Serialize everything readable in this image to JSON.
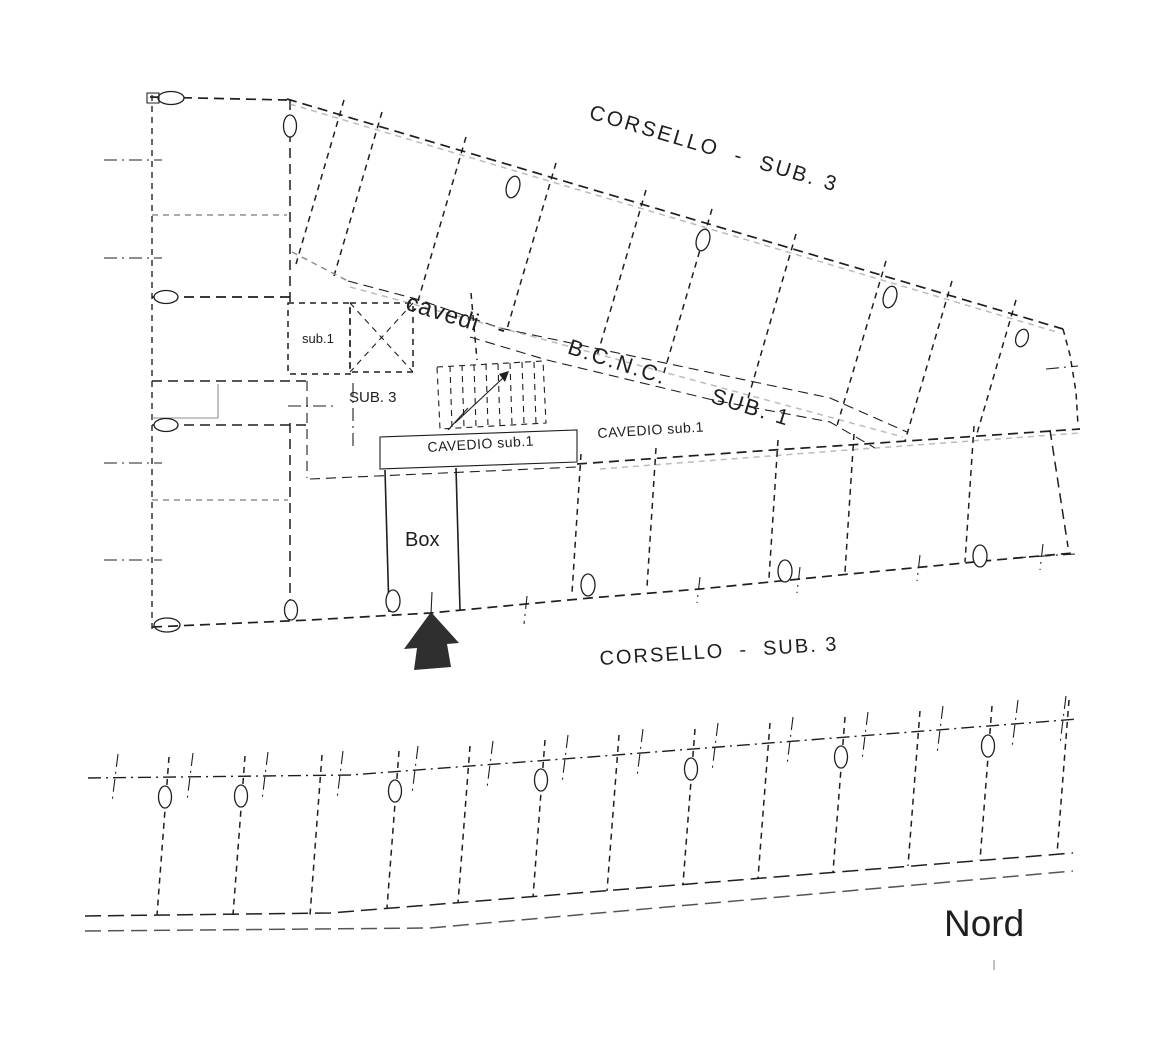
{
  "labels": {
    "corsello_top": "CORSELLO  -  SUB. 3",
    "cavedi": "cavedi",
    "corridor_dash": "-",
    "bcnc": "B.C.N.C.",
    "sub_1": "SUB. 1",
    "sub1_room": "sub.1",
    "sub3_room": "SUB. 3",
    "cavedio_box": "CAVEDIO sub.1",
    "cavedio_right": "CAVEDIO sub.1",
    "box": "Box",
    "corsello_mid": "CORSELLO  -  SUB. 3",
    "nord": "Nord"
  },
  "colors": {
    "ink": "#1f1f1f",
    "faded": "#8f8f8f",
    "paper": "#ffffff"
  }
}
